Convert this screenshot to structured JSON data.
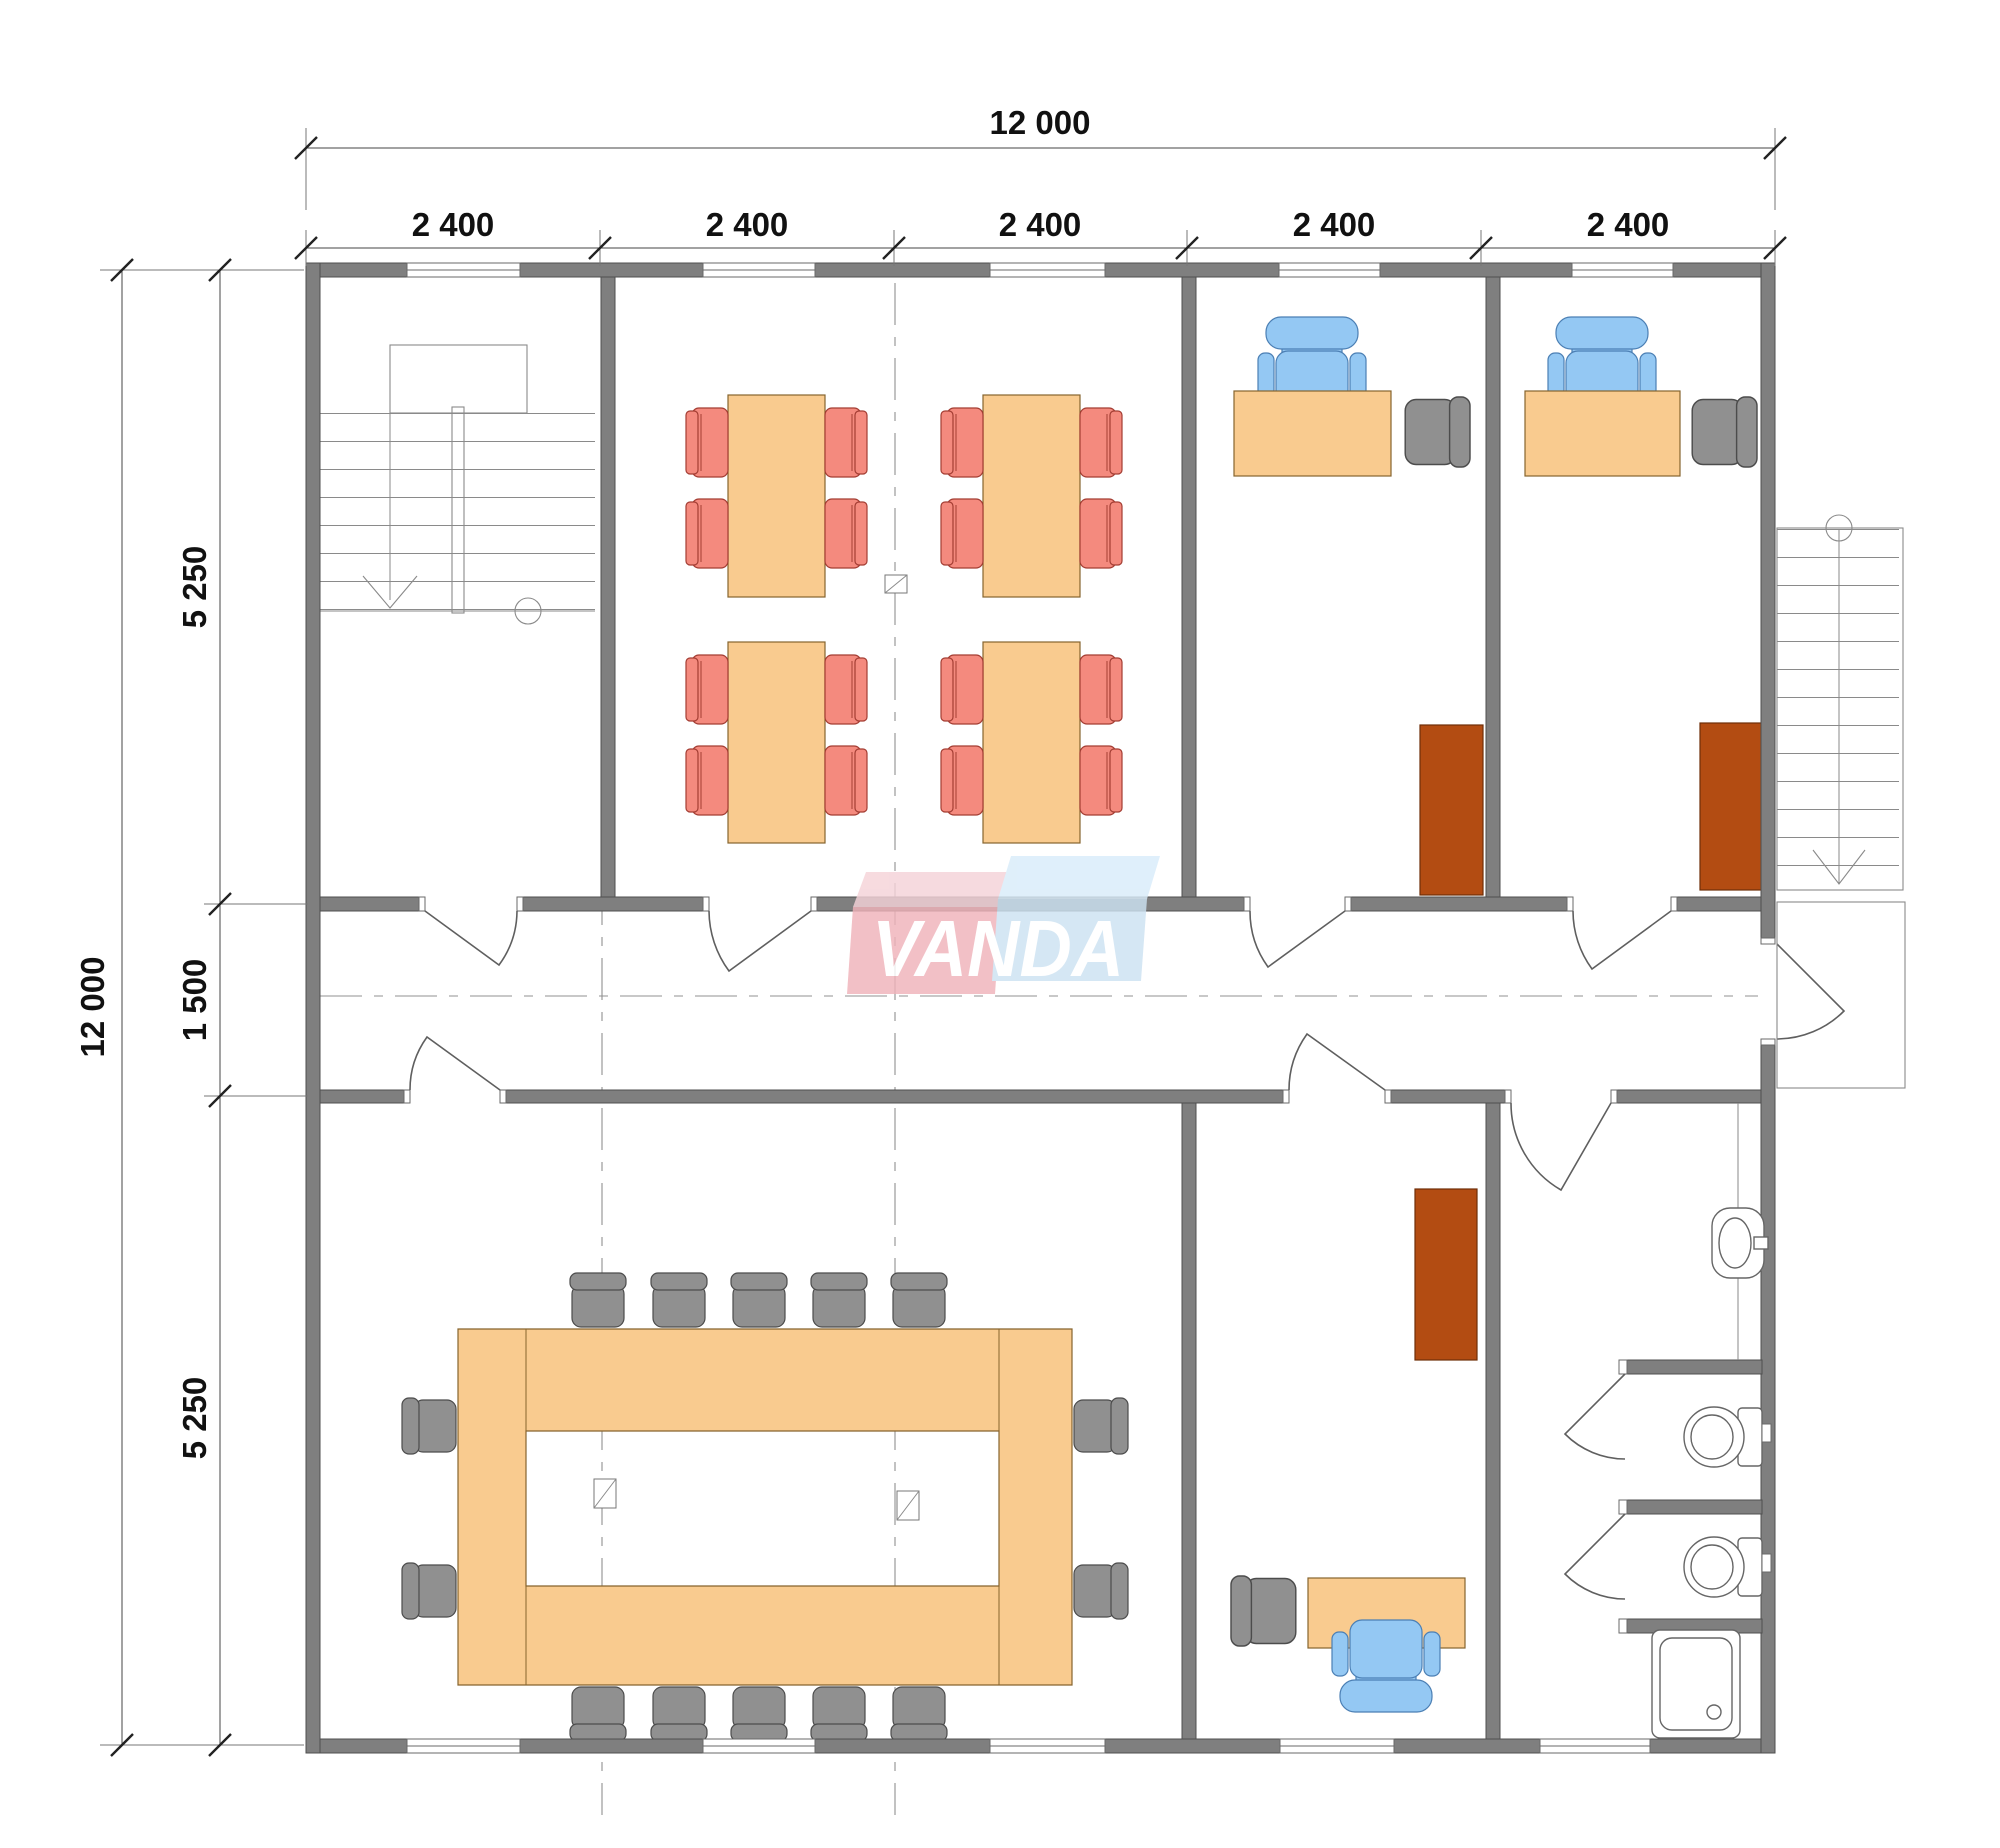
{
  "drawing": {
    "kind": "office floor plan",
    "watermark": {
      "text": "VANDA"
    }
  },
  "dimensions": {
    "top": {
      "total": "12 000",
      "segments": [
        "2 400",
        "2 400",
        "2 400",
        "2 400",
        "2 400"
      ]
    },
    "left": {
      "total": "12 000",
      "segments": [
        "5 250",
        "1 500",
        "5 250"
      ]
    }
  },
  "inventory": {
    "classroom_tables": 4,
    "classroom_chairs": 16,
    "conference_seats": 14,
    "office_desks": 3,
    "task_chairs": 3,
    "guest_chairs": 3,
    "cabinets": 3,
    "staircases": 2,
    "toilets": 2,
    "sinks": 1,
    "showers": 1
  },
  "colors": {
    "wall": "#7f7f7f",
    "table": "#f9cb8f",
    "chair_red": "#f48a7e",
    "chair_blue": "#94c8f3",
    "chair_gray": "#909090",
    "cabinet": "#b34c12",
    "logo_pink": "#f0b3ba",
    "logo_blue": "#cde2f2"
  }
}
